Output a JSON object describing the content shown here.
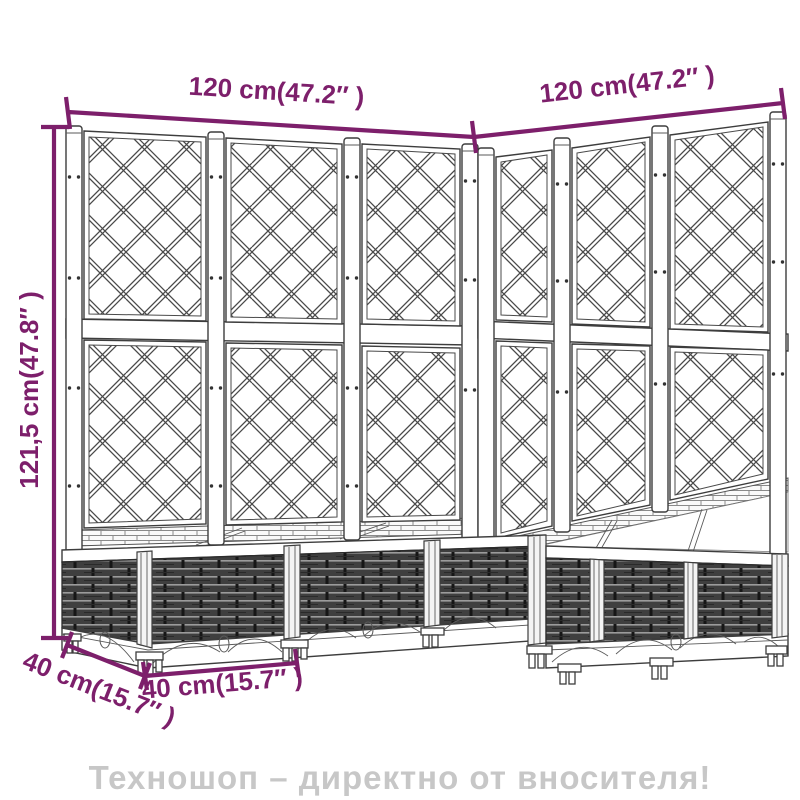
{
  "diagram": {
    "labels": {
      "width_left": "120 cm(47.2″ )",
      "width_right": "120 cm(47.2″ )",
      "height": "121,5 cm(47.8″ )",
      "depth": "40 cm(15.7″ )",
      "box_width": "40 cm(15.7″ )"
    },
    "colors": {
      "dimension": "#7d1f6b",
      "line_art": "#3d3d3d",
      "wicker": "#3f3f3f",
      "watermark": "#c7c7c7",
      "background": "#ffffff"
    }
  },
  "watermark": {
    "text": "Техношоп – директно от вносителя!"
  }
}
